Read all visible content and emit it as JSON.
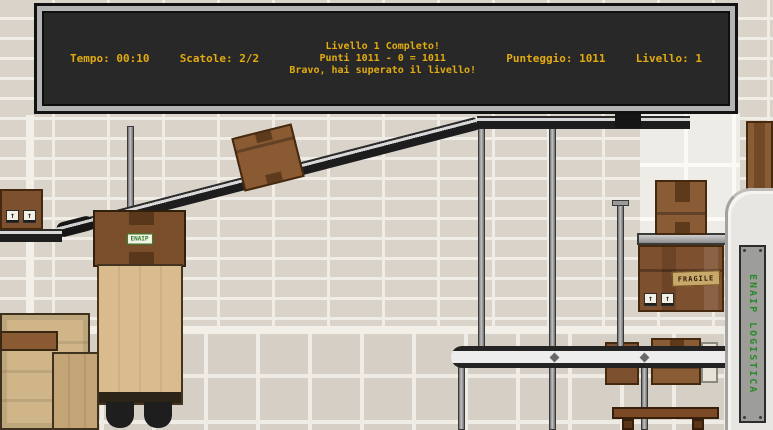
{
  "hud": {
    "tempo": "Tempo: 00:10",
    "scatole": "Scatole: 2/2",
    "message_line1": "Livello 1 Completo!",
    "message_line2": "Punti 1011 - 0 = 1011",
    "message_line3": "Bravo, hai superato il livello!",
    "punteggio": "Punteggio: 1011",
    "livello": "Livello: 1",
    "text_color": "#e2ab10",
    "panel_bg": "#282828",
    "frame_color": "#b4b4b4"
  },
  "scene": {
    "hopper_label": "ENAIP",
    "pillar_sign": "ENAIP LOGISTICA",
    "fragile_label": "FRAGILE",
    "up_arrow": "↑"
  },
  "colors": {
    "wall": "#d9d3ca",
    "cardboard": "#8a5a33",
    "belt_dark": "#1f1f1f",
    "accent_green": "#2a8a2a",
    "hud_yellow": "#e2ab10"
  }
}
